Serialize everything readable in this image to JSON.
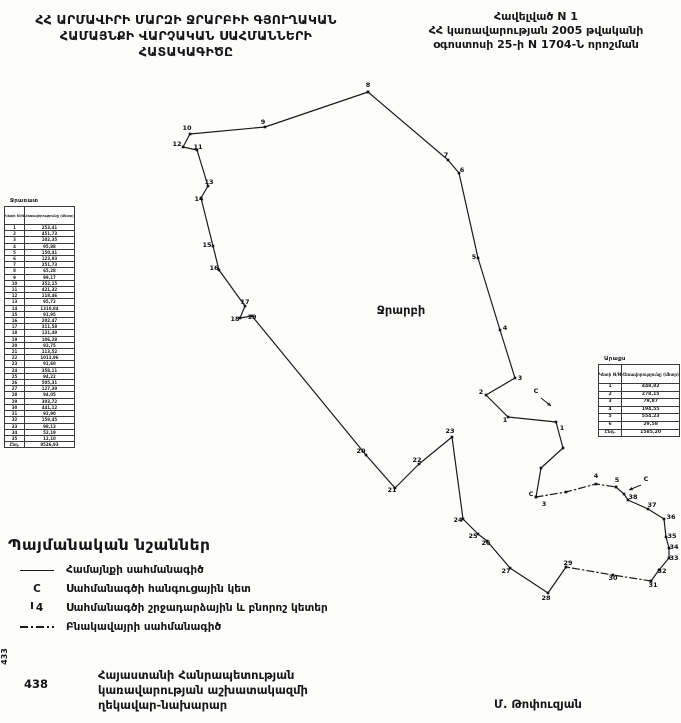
{
  "header": {
    "title_lines": [
      "ՀՀ ԱՐՄԱՎԻՐԻ ՄԱՐԶԻ ՋՐԱՐԲԻԻ ԳՅՈՒՂԱԿԱՆ",
      "ՀԱՄԱՅՆՔԻ ՎԱՐՉԱԿԱՆ ՍԱՀՄԱՆՆԵՐԻ",
      "ՀԱՏԱԿԱԳԻԾԸ"
    ],
    "annex_lines": [
      "Հավելված N 1",
      "ՀՀ կառավարության 2005 թվականի",
      "օգոստոսի 25-ի N 1704-Ն որոշման"
    ]
  },
  "map": {
    "region_label": "Ջրարբի",
    "segments": [
      {
        "style": "solid",
        "points": [
          [
            368,
            92
          ],
          [
            448,
            160
          ],
          [
            459,
            173
          ],
          [
            478,
            258
          ],
          [
            500,
            330
          ],
          [
            515,
            378
          ],
          [
            486,
            395
          ],
          [
            508,
            417
          ],
          [
            556,
            422
          ],
          [
            563,
            448
          ],
          [
            541,
            468
          ],
          [
            536,
            497
          ]
        ]
      },
      {
        "style": "dashdot",
        "points": [
          [
            536,
            497
          ],
          [
            566,
            492
          ],
          [
            596,
            484
          ],
          [
            616,
            487
          ]
        ]
      },
      {
        "style": "solid",
        "points": [
          [
            616,
            487
          ],
          [
            624,
            494
          ],
          [
            628,
            500
          ],
          [
            648,
            509
          ],
          [
            664,
            519
          ],
          [
            666,
            537
          ],
          [
            669,
            548
          ],
          [
            669,
            558
          ],
          [
            659,
            570
          ],
          [
            651,
            581
          ]
        ]
      },
      {
        "style": "dashdot",
        "points": [
          [
            651,
            581
          ],
          [
            613,
            575
          ],
          [
            566,
            567
          ]
        ]
      },
      {
        "style": "solid",
        "points": [
          [
            566,
            567
          ],
          [
            548,
            593
          ],
          [
            510,
            568
          ],
          [
            487,
            541
          ],
          [
            478,
            534
          ],
          [
            463,
            519
          ],
          [
            452,
            437
          ],
          [
            419,
            464
          ],
          [
            395,
            488
          ],
          [
            366,
            455
          ],
          [
            252,
            316
          ],
          [
            240,
            318
          ],
          [
            245,
            306
          ],
          [
            219,
            270
          ],
          [
            213,
            246
          ],
          [
            201,
            198
          ],
          [
            208,
            186
          ],
          [
            197,
            150
          ],
          [
            183,
            147
          ],
          [
            190,
            134
          ],
          [
            265,
            127
          ],
          [
            368,
            92
          ]
        ]
      }
    ],
    "point_labels": [
      {
        "n": "8",
        "x": 368,
        "y": 87
      },
      {
        "n": "9",
        "x": 263,
        "y": 124
      },
      {
        "n": "10",
        "x": 187,
        "y": 130
      },
      {
        "n": "12",
        "x": 177,
        "y": 146
      },
      {
        "n": "11",
        "x": 198,
        "y": 149
      },
      {
        "n": "13",
        "x": 209,
        "y": 184
      },
      {
        "n": "14",
        "x": 199,
        "y": 201
      },
      {
        "n": "15",
        "x": 207,
        "y": 247
      },
      {
        "n": "16",
        "x": 214,
        "y": 270
      },
      {
        "n": "17",
        "x": 245,
        "y": 304
      },
      {
        "n": "18",
        "x": 235,
        "y": 321
      },
      {
        "n": "19",
        "x": 252,
        "y": 319
      },
      {
        "n": "7",
        "x": 446,
        "y": 157
      },
      {
        "n": "6",
        "x": 462,
        "y": 172
      },
      {
        "n": "5",
        "x": 474,
        "y": 259
      },
      {
        "n": "4",
        "x": 505,
        "y": 330
      },
      {
        "n": "3",
        "x": 520,
        "y": 380
      },
      {
        "n": "2",
        "x": 481,
        "y": 394
      },
      {
        "n": "1",
        "x": 505,
        "y": 422
      },
      {
        "n": "C",
        "x": 536,
        "y": 393
      },
      {
        "n": "1",
        "x": 562,
        "y": 430
      },
      {
        "n": "20",
        "x": 361,
        "y": 453
      },
      {
        "n": "21",
        "x": 392,
        "y": 492
      },
      {
        "n": "22",
        "x": 417,
        "y": 462
      },
      {
        "n": "23",
        "x": 450,
        "y": 433
      },
      {
        "n": "24",
        "x": 458,
        "y": 522
      },
      {
        "n": "25",
        "x": 473,
        "y": 538
      },
      {
        "n": "26",
        "x": 486,
        "y": 545
      },
      {
        "n": "27",
        "x": 506,
        "y": 573
      },
      {
        "n": "28",
        "x": 546,
        "y": 600
      },
      {
        "n": "29",
        "x": 568,
        "y": 565
      },
      {
        "n": "30",
        "x": 613,
        "y": 580
      },
      {
        "n": "31",
        "x": 653,
        "y": 587
      },
      {
        "n": "32",
        "x": 662,
        "y": 573
      },
      {
        "n": "33",
        "x": 674,
        "y": 560
      },
      {
        "n": "34",
        "x": 674,
        "y": 549
      },
      {
        "n": "35",
        "x": 672,
        "y": 538
      },
      {
        "n": "36",
        "x": 671,
        "y": 519
      },
      {
        "n": "37",
        "x": 652,
        "y": 507
      },
      {
        "n": "38",
        "x": 633,
        "y": 499
      },
      {
        "n": "5",
        "x": 617,
        "y": 482
      },
      {
        "n": "4",
        "x": 596,
        "y": 478
      },
      {
        "n": "C",
        "x": 646,
        "y": 481
      },
      {
        "n": "C",
        "x": 531,
        "y": 496
      },
      {
        "n": "3",
        "x": 544,
        "y": 506
      }
    ],
    "arrows": [
      {
        "x1": 641,
        "y1": 485,
        "x2": 629,
        "y2": 490
      },
      {
        "x1": 541,
        "y1": 398,
        "x2": 551,
        "y2": 406
      }
    ]
  },
  "left_table": {
    "title": "Ջրառատ",
    "col1_header": "Կետի N/N",
    "col2_header": "Հեռավորությունը (մետր)",
    "rows": [
      [
        "1",
        "253,41"
      ],
      [
        "2",
        "451,73"
      ],
      [
        "3",
        "102,35"
      ],
      [
        "4",
        "95,88"
      ],
      [
        "5",
        "150,41"
      ],
      [
        "6",
        "123,93"
      ],
      [
        "7",
        "251,73"
      ],
      [
        "8",
        "65,28"
      ],
      [
        "9",
        "99,17"
      ],
      [
        "10",
        "352,15"
      ],
      [
        "11",
        "421,32"
      ],
      [
        "12",
        "118,46"
      ],
      [
        "13",
        "95,72"
      ],
      [
        "14",
        "1310,84"
      ],
      [
        "15",
        "91,95"
      ],
      [
        "16",
        "202,47"
      ],
      [
        "17",
        "311,58"
      ],
      [
        "18",
        "131,49"
      ],
      [
        "19",
        "106,28"
      ],
      [
        "20",
        "92,75"
      ],
      [
        "21",
        "113,52"
      ],
      [
        "22",
        "1013,96"
      ],
      [
        "23",
        "91,60"
      ],
      [
        "24",
        "358,11"
      ],
      [
        "25",
        "94,22"
      ],
      [
        "26",
        "505,31"
      ],
      [
        "27",
        "127,39"
      ],
      [
        "28",
        "94,05"
      ],
      [
        "29",
        "303,72"
      ],
      [
        "30",
        "441,12"
      ],
      [
        "31",
        "92,90"
      ],
      [
        "32",
        "159,45"
      ],
      [
        "33",
        "98,13"
      ],
      [
        "34",
        "52,19"
      ],
      [
        "35",
        "12,10"
      ]
    ],
    "total": [
      "Ընդ.",
      "8536,93"
    ]
  },
  "right_table": {
    "title": "Արաքս",
    "col1_header": "Կետի N/N",
    "col2_header": "Հեռավորությունը (մետր)",
    "rows": [
      [
        "1",
        "448,82"
      ],
      [
        "2",
        "278,15"
      ],
      [
        "3",
        "79,87"
      ],
      [
        "4",
        "194,55"
      ],
      [
        "5",
        "554,23"
      ],
      [
        "6",
        "29,58"
      ]
    ],
    "total": [
      "Ընդ.",
      "1585,20"
    ]
  },
  "legend": {
    "title": "Պայմանական նշաններ",
    "items": [
      {
        "symbol": "line-solid",
        "label": "Համայնքի սահմանագիծ"
      },
      {
        "symbol": "C",
        "label": "Սահմանագծի հանգուցային կետ"
      },
      {
        "symbol": "4",
        "label": "Սահմանագծի շրջադարձային և բնորոշ կետեր"
      },
      {
        "symbol": "line-dashdot",
        "label": "Բնակավայրի սահմանագիծ"
      }
    ]
  },
  "footer": {
    "lines": [
      "Հայաստանի Հանրապետության",
      "կառավարության աշխատակազմի",
      "ղեկավար-նախարար"
    ],
    "signature": "Մ. Թոփուզյան",
    "page_number": "438",
    "margin_number": "433"
  },
  "colors": {
    "ink": "#161616",
    "paper": "#fdfdfc"
  }
}
